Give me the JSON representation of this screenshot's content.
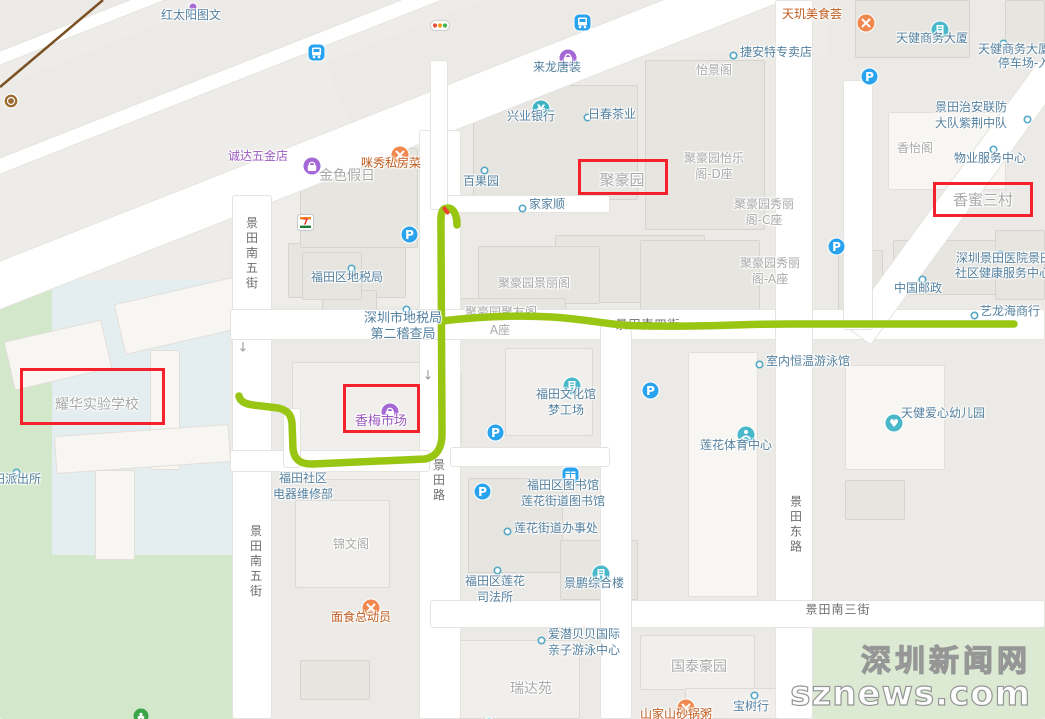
{
  "meta": {
    "route_color": "#98c613",
    "highlight_color": "#f5222d",
    "railway_color": "#7a5124"
  },
  "watermark": {
    "line1": "深圳新闻网",
    "line2": "sznews.com"
  },
  "streets": [
    {
      "name": "景田南五街",
      "dir": "v",
      "x": 252,
      "y": 254
    },
    {
      "name": "景田南五街",
      "dir": "v",
      "x": 256,
      "y": 562
    },
    {
      "name": "景田路",
      "dir": "v",
      "x": 439,
      "y": 481
    },
    {
      "name": "景田东路",
      "dir": "v",
      "x": 796,
      "y": 525
    },
    {
      "name": "景田南三街",
      "dir": "h",
      "x": 838,
      "y": 609
    },
    {
      "name": "景田南四街",
      "dir": "h",
      "x": 648,
      "y": 324,
      "under": true
    }
  ],
  "highlights": [
    {
      "name": "juhaoyuan",
      "label": "聚豪园",
      "x": 578,
      "y": 159,
      "w": 90,
      "h": 36
    },
    {
      "name": "xiangmi-sancun",
      "label": "香蜜三村",
      "x": 933,
      "y": 182,
      "w": 100,
      "h": 35
    },
    {
      "name": "xiangmei-market",
      "label": "香梅市场",
      "x": 343,
      "y": 384,
      "w": 77,
      "h": 49
    },
    {
      "name": "yaohua-school",
      "label": "耀华实验学校",
      "x": 20,
      "y": 368,
      "w": 145,
      "h": 57
    }
  ],
  "pois": [
    {
      "text": "红太阳图文",
      "x": 191,
      "y": 15,
      "cls": "b"
    },
    {
      "text": "诚达五金店",
      "x": 258,
      "y": 156,
      "cls": "p"
    },
    {
      "text": "咪秀私房菜",
      "x": 391,
      "y": 163,
      "cls": "o"
    },
    {
      "text": "金色假日",
      "x": 347,
      "y": 176,
      "cls": "g",
      "size": 14
    },
    {
      "text": "来龙唐装",
      "x": 557,
      "y": 67,
      "cls": "b"
    },
    {
      "text": "兴业银行",
      "x": 531,
      "y": 116,
      "cls": "b"
    },
    {
      "text": "日春茶业",
      "x": 612,
      "y": 114,
      "cls": "b"
    },
    {
      "text": "百果园",
      "x": 481,
      "y": 181,
      "cls": "b"
    },
    {
      "text": "家家顺",
      "x": 547,
      "y": 204,
      "cls": "b"
    },
    {
      "text": "聚豪园",
      "x": 622,
      "y": 180,
      "cls": "g",
      "size": 15
    },
    {
      "text": "怡景阁",
      "x": 714,
      "y": 70,
      "cls": "g"
    },
    {
      "text": "捷安特专卖店",
      "x": 776,
      "y": 52,
      "cls": "b"
    },
    {
      "text": "天玑美食荟",
      "x": 812,
      "y": 14,
      "cls": "o"
    },
    {
      "text": "天健商务大厦",
      "x": 932,
      "y": 38,
      "cls": "b"
    },
    {
      "text": "天健商务大厦",
      "x": 1014,
      "y": 49,
      "cls": "b"
    },
    {
      "text": "停车场-入口",
      "x": 1030,
      "y": 63,
      "cls": "b"
    },
    {
      "lines": [
        "景田治安联防",
        "大队紫荆中队"
      ],
      "x": 971,
      "y": 115,
      "cls": "b"
    },
    {
      "text": "香怡阁",
      "x": 915,
      "y": 148,
      "cls": "g"
    },
    {
      "text": "物业服务中心",
      "x": 990,
      "y": 158,
      "cls": "b"
    },
    {
      "text": "香蜜三村",
      "x": 983,
      "y": 200,
      "cls": "g",
      "size": 15
    },
    {
      "lines": [
        "聚豪园怡乐",
        "阁-D座"
      ],
      "x": 714,
      "y": 166,
      "cls": "g"
    },
    {
      "lines": [
        "聚豪园秀丽",
        "阁-C座"
      ],
      "x": 764,
      "y": 212,
      "cls": "g"
    },
    {
      "lines": [
        "聚豪园秀丽",
        "阁-A座"
      ],
      "x": 770,
      "y": 271,
      "cls": "g"
    },
    {
      "text": "聚豪园景丽阁",
      "x": 534,
      "y": 283,
      "cls": "g"
    },
    {
      "text": "聚豪园聚友阁",
      "x": 501,
      "y": 312,
      "cls": "g",
      "under": true
    },
    {
      "text": "A座",
      "x": 500,
      "y": 330,
      "cls": "g",
      "under": true
    },
    {
      "text": "中国邮政",
      "x": 918,
      "y": 288,
      "cls": "b"
    },
    {
      "text": "深圳景田医院景田",
      "left": 956,
      "y": 258,
      "cls": "b"
    },
    {
      "text": "社区健康服务中心",
      "left": 955,
      "y": 273,
      "cls": "b"
    },
    {
      "text": "艺龙海商行",
      "x": 1010,
      "y": 311,
      "cls": "b"
    },
    {
      "text": "福田区地税局",
      "x": 347,
      "y": 277,
      "cls": "b"
    },
    {
      "lines": [
        "深圳市地税局",
        "第二稽查局"
      ],
      "x": 403,
      "y": 327,
      "cls": "b",
      "size": 13
    },
    {
      "text": "香梅市场",
      "x": 381,
      "y": 422,
      "cls": "p",
      "size": 13
    },
    {
      "lines": [
        "福田文化馆",
        "梦工场"
      ],
      "x": 566,
      "y": 402,
      "cls": "b"
    },
    {
      "text": "室内恒温游泳馆",
      "x": 808,
      "y": 361,
      "cls": "b"
    },
    {
      "text": "莲花体育中心",
      "x": 736,
      "y": 445,
      "cls": "b"
    },
    {
      "text": "天健爱心幼儿园",
      "x": 943,
      "y": 413,
      "cls": "b"
    },
    {
      "text": "耀华实验学校",
      "x": 97,
      "y": 405,
      "cls": "g",
      "size": 14
    },
    {
      "text": "田派出所",
      "left": -7,
      "y": 479,
      "cls": "b"
    },
    {
      "lines": [
        "福田社区",
        "电器维修部"
      ],
      "x": 303,
      "y": 486,
      "cls": "b"
    },
    {
      "text": "锦文阁",
      "x": 351,
      "y": 544,
      "cls": "g"
    },
    {
      "text": "面食总动员",
      "x": 361,
      "y": 617,
      "cls": "o"
    },
    {
      "lines": [
        "福田区图书馆",
        "莲花街道图书馆"
      ],
      "x": 563,
      "y": 493,
      "cls": "b"
    },
    {
      "text": "莲花街道办事处",
      "x": 556,
      "y": 528,
      "cls": "b"
    },
    {
      "lines": [
        "福田区莲花",
        "司法所"
      ],
      "x": 495,
      "y": 589,
      "cls": "b"
    },
    {
      "text": "景鹏综合楼",
      "x": 594,
      "y": 583,
      "cls": "b"
    },
    {
      "lines": [
        "爱潜贝贝国际",
        "亲子游泳中心"
      ],
      "x": 584,
      "y": 642,
      "cls": "b"
    },
    {
      "text": "瑞达苑",
      "x": 531,
      "y": 689,
      "cls": "g",
      "size": 14
    },
    {
      "text": "国泰豪园",
      "x": 699,
      "y": 667,
      "cls": "g",
      "size": 14
    },
    {
      "text": "宝树行",
      "x": 751,
      "y": 706,
      "cls": "b"
    },
    {
      "text": "山家山砂锅粥",
      "x": 676,
      "y": 714,
      "cls": "o"
    }
  ],
  "icons": [
    {
      "type": "dot",
      "x": 583,
      "y": 113
    },
    {
      "type": "dot",
      "x": 480,
      "y": 166
    },
    {
      "type": "dot",
      "x": 518,
      "y": 204
    },
    {
      "type": "dot",
      "x": 729,
      "y": 51
    },
    {
      "type": "dot",
      "x": 999,
      "y": 39
    },
    {
      "type": "dot",
      "x": 1023,
      "y": 115
    },
    {
      "type": "dot",
      "x": 989,
      "y": 145
    },
    {
      "type": "dot",
      "x": 918,
      "y": 275
    },
    {
      "type": "dot",
      "x": 996,
      "y": 250
    },
    {
      "type": "dot",
      "x": 970,
      "y": 311
    },
    {
      "type": "dot",
      "x": 347,
      "y": 264
    },
    {
      "type": "dot",
      "x": 402,
      "y": 305
    },
    {
      "type": "dot",
      "x": 755,
      "y": 360
    },
    {
      "type": "dot",
      "x": 12,
      "y": 468
    },
    {
      "type": "dot",
      "x": 503,
      "y": 527
    },
    {
      "type": "dot",
      "x": 493,
      "y": 566
    },
    {
      "type": "dot",
      "x": 537,
      "y": 636
    },
    {
      "type": "dot",
      "x": 750,
      "y": 691
    },
    {
      "type": "purpledot",
      "x": 188,
      "y": 2
    },
    {
      "type": "parking",
      "x": 860,
      "y": 67
    },
    {
      "type": "parking",
      "x": 400,
      "y": 225
    },
    {
      "type": "parking",
      "x": 827,
      "y": 237
    },
    {
      "type": "parking",
      "x": 641,
      "y": 381
    },
    {
      "type": "parking",
      "x": 486,
      "y": 423
    },
    {
      "type": "parking",
      "x": 473,
      "y": 482
    },
    {
      "type": "bus",
      "x": 307,
      "y": 43
    },
    {
      "type": "bus",
      "x": 573,
      "y": 13
    },
    {
      "type": "bag",
      "x": 302,
      "y": 156
    },
    {
      "type": "bag",
      "x": 558,
      "y": 48
    },
    {
      "type": "bag",
      "x": 380,
      "y": 402
    },
    {
      "type": "bank",
      "x": 531,
      "y": 99
    },
    {
      "type": "restaurant",
      "x": 390,
      "y": 145
    },
    {
      "type": "restaurant",
      "x": 856,
      "y": 13
    },
    {
      "type": "restaurant",
      "x": 361,
      "y": 598
    },
    {
      "type": "restaurant",
      "x": 676,
      "y": 698
    },
    {
      "type": "building",
      "x": 930,
      "y": 20
    },
    {
      "type": "building",
      "x": 562,
      "y": 376
    },
    {
      "type": "building",
      "x": 591,
      "y": 564
    },
    {
      "type": "library",
      "x": 561,
      "y": 466
    },
    {
      "type": "sport",
      "x": 736,
      "y": 425
    },
    {
      "type": "kindergarten",
      "x": 884,
      "y": 413
    },
    {
      "type": "seven-eleven",
      "x": 297,
      "y": 214
    },
    {
      "type": "traffic-light",
      "x": 430,
      "y": 20
    },
    {
      "type": "metro",
      "x": 3,
      "y": 93
    },
    {
      "type": "tree",
      "x": 133,
      "y": 708
    },
    {
      "type": "tealdot",
      "x": 482,
      "y": 717
    },
    {
      "type": "down-arrow",
      "x": 243,
      "y": 348
    },
    {
      "type": "down-arrow",
      "x": 428,
      "y": 376
    }
  ],
  "route": {
    "main": "M457,225 C457,213 452,205 444,209 C440,212 441,221 441,232 L442,434 C442,447 437,457 425,459 L313,464 C300,464.5 294,459 293,449 L292,423 C291,414 287,410 278,408 L253,405 C245,404 240,401 239,396",
    "branch": "M442,321 C475,317 515,315 552,317 C597,320 607,326 652,326 C710,327 735,324 790,324 L1014,324",
    "tick": {
      "x": 444,
      "y": 206
    }
  },
  "railway": {
    "path": "M0,87 L103,0"
  }
}
